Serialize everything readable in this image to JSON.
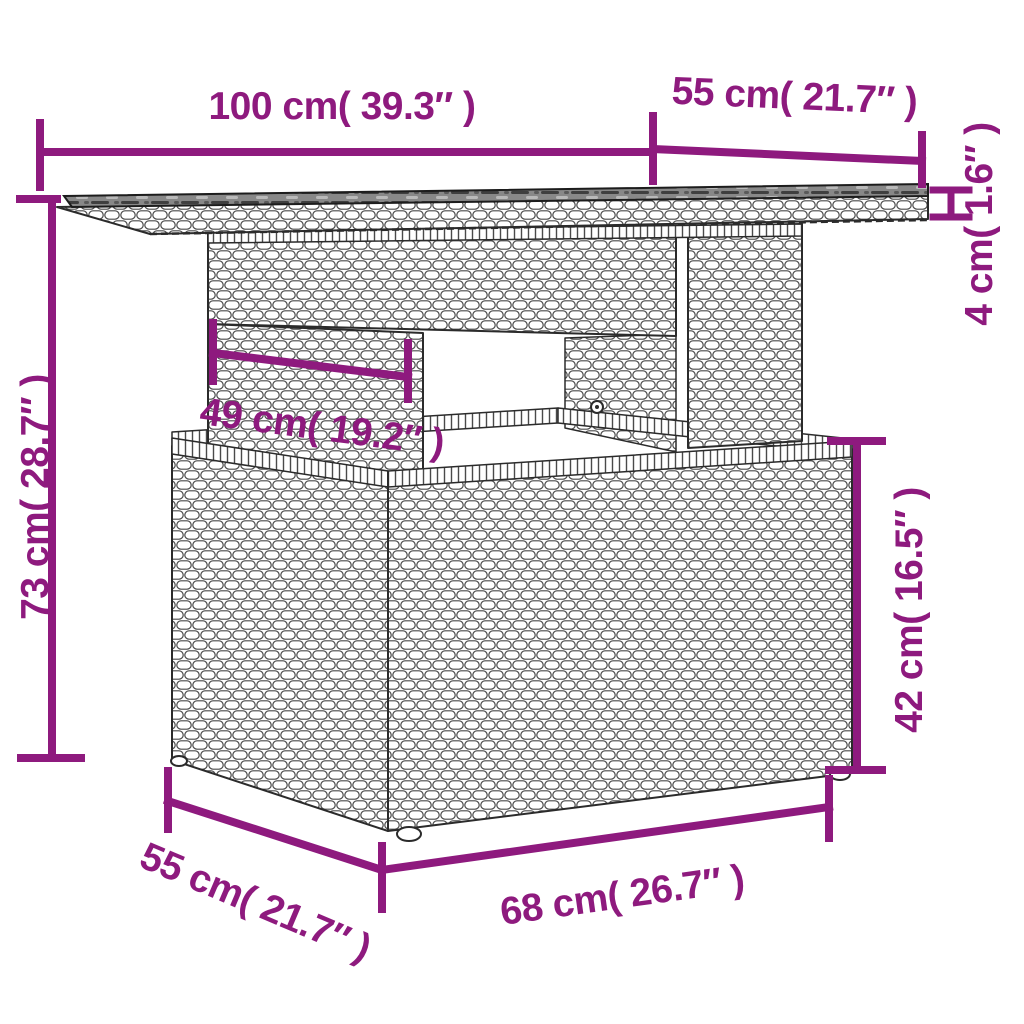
{
  "diagram": {
    "type": "furniture-dimension-drawing",
    "subject": "poly rattan garden table with glass top",
    "accent_color": "#8E1A7E",
    "background_color": "#FFFFFF",
    "line_art_color": "#2B2B2B"
  },
  "dimensions": {
    "top_length": "100 cm( 39.3″ )",
    "top_depth": "55 cm( 21.7″ )",
    "top_thickness": "4 cm( 1.6″ )",
    "total_height": "73 cm( 28.7″ )",
    "pedestal_width": "49 cm( 19.2″ )",
    "base_height": "42 cm( 16.5″ )",
    "base_depth": "55 cm( 21.7″ )",
    "base_length": "68 cm( 26.7″ )"
  }
}
